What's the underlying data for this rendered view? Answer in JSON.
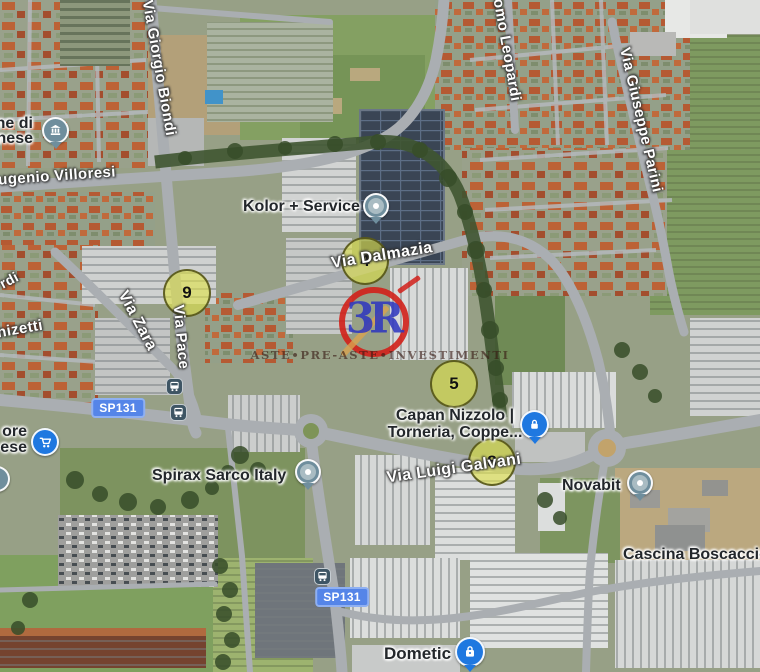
{
  "map": {
    "street_labels": [
      {
        "text": "Via Giorgio Biondi"
      },
      {
        "text": "omo Leopardi"
      },
      {
        "text": "Via Giuseppe Parini"
      },
      {
        "text": "ugenio Villoresi"
      },
      {
        "text": "Via Dalmazia"
      },
      {
        "text": "rdi"
      },
      {
        "text": "Via Zara"
      },
      {
        "text": "nizetti"
      },
      {
        "text": "Via Pace"
      },
      {
        "text": "Via Luigi Galvani"
      }
    ],
    "poi_labels": {
      "comune": {
        "line1": "ne di",
        "line2": "nese",
        "icon": "town-hall-icon"
      },
      "kolor": {
        "label": "Kolor + Service",
        "icon": "generic-poi-icon"
      },
      "supermarket": {
        "line1": "ore",
        "line2": "ese",
        "icon": "shopping-cart-icon"
      },
      "spirax": {
        "label": "Spirax Sarco Italy",
        "icon": "generic-poi-icon"
      },
      "capan": {
        "line1": "Capan Nizzolo |",
        "line2": "Torneria, Coppe...",
        "icon": "lock-icon"
      },
      "novabit": {
        "label": "Novabit",
        "icon": "generic-poi-icon"
      },
      "cascina": {
        "label": "Cascina Boscaccio"
      },
      "dometic": {
        "label": "Dometic",
        "icon": "shopping-bag-icon"
      }
    },
    "road_badges": [
      {
        "label": "SP131"
      },
      {
        "label": "SP131"
      }
    ],
    "numbered_markers": [
      {
        "number": "9"
      },
      {
        "number": "4"
      },
      {
        "number": "5"
      },
      {
        "number": "8"
      }
    ],
    "watermark": {
      "logo_text": "3R",
      "caption": "ASTE•PRE-ASTE•INVESTIMENTI"
    },
    "transit": {
      "bus_stop_count": "3"
    }
  },
  "colors": {
    "marker_yellow": "#dfe24a",
    "badge_blue": "#5585e8",
    "poi_blue": "#1f78e0",
    "poi_slate": "#6f8e9d",
    "watermark_red": "#d2201a",
    "watermark_blue": "#2d35c0"
  }
}
